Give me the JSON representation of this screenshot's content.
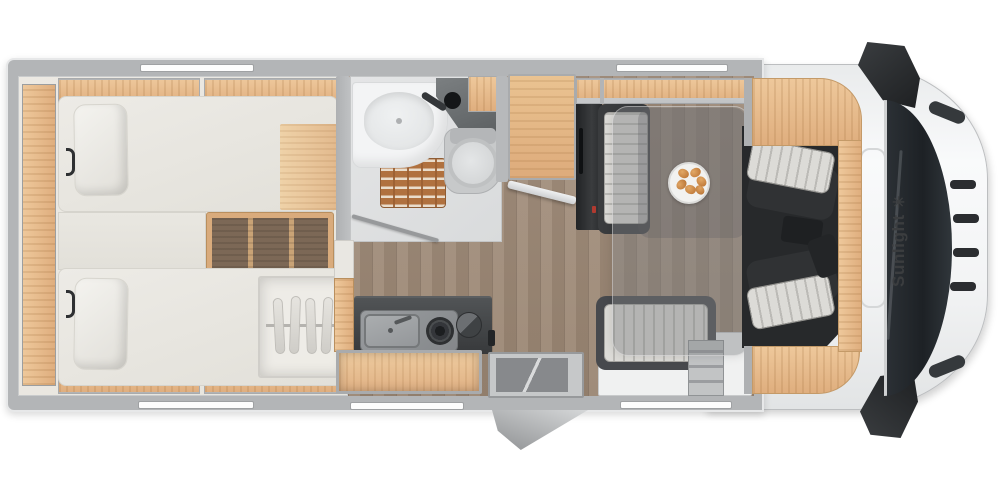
{
  "brand": {
    "label": "Sunlight",
    "logo_glyph": "✳"
  },
  "image": {
    "kind": "motorhome-floorplan-top-view",
    "areas": [
      "twin-bedroom",
      "bathroom",
      "kitchen",
      "wardrobe",
      "entry",
      "dinette",
      "cab"
    ],
    "fixtures": [
      "twin-bed-top",
      "twin-bed-bottom",
      "bed-steps",
      "hanger-wardrobe",
      "reading-lights",
      "washbasin",
      "vanity-counter",
      "toilet",
      "shower-teak-mat",
      "bathroom-door",
      "tall-cabinet",
      "cabinet-door-open",
      "fridge-unit",
      "kitchen-counter",
      "kitchen-sink",
      "gas-hob",
      "round-board",
      "open-drawer",
      "entry-step",
      "exterior-step",
      "dinette-table",
      "plate-with-croissants",
      "side-bench",
      "rear-bench",
      "cab-seat-left",
      "cab-seat-right",
      "overcab-bed-frame",
      "windshield",
      "grille",
      "side-mirror-top",
      "side-mirror-bottom",
      "roof-hatch"
    ],
    "windows_count": 5
  },
  "colors": {
    "wall_gray": "#b3b5b7",
    "cabinet_wood": "#e2b485",
    "dark_step_wood": "#7c6856",
    "bedroom_floor": "#eae8e2",
    "plank_floor": "#a08d7d",
    "counter_dark": "#3f4143",
    "upholstery_stripe": "#d7d6d2",
    "seat_frame": "#303234",
    "cab_white": "#f6f7f8",
    "glass_dark": "#23272b",
    "teak_mat": "#b0713f",
    "accent_red": "#b03a30",
    "brand_text": "#3b3d3f"
  }
}
